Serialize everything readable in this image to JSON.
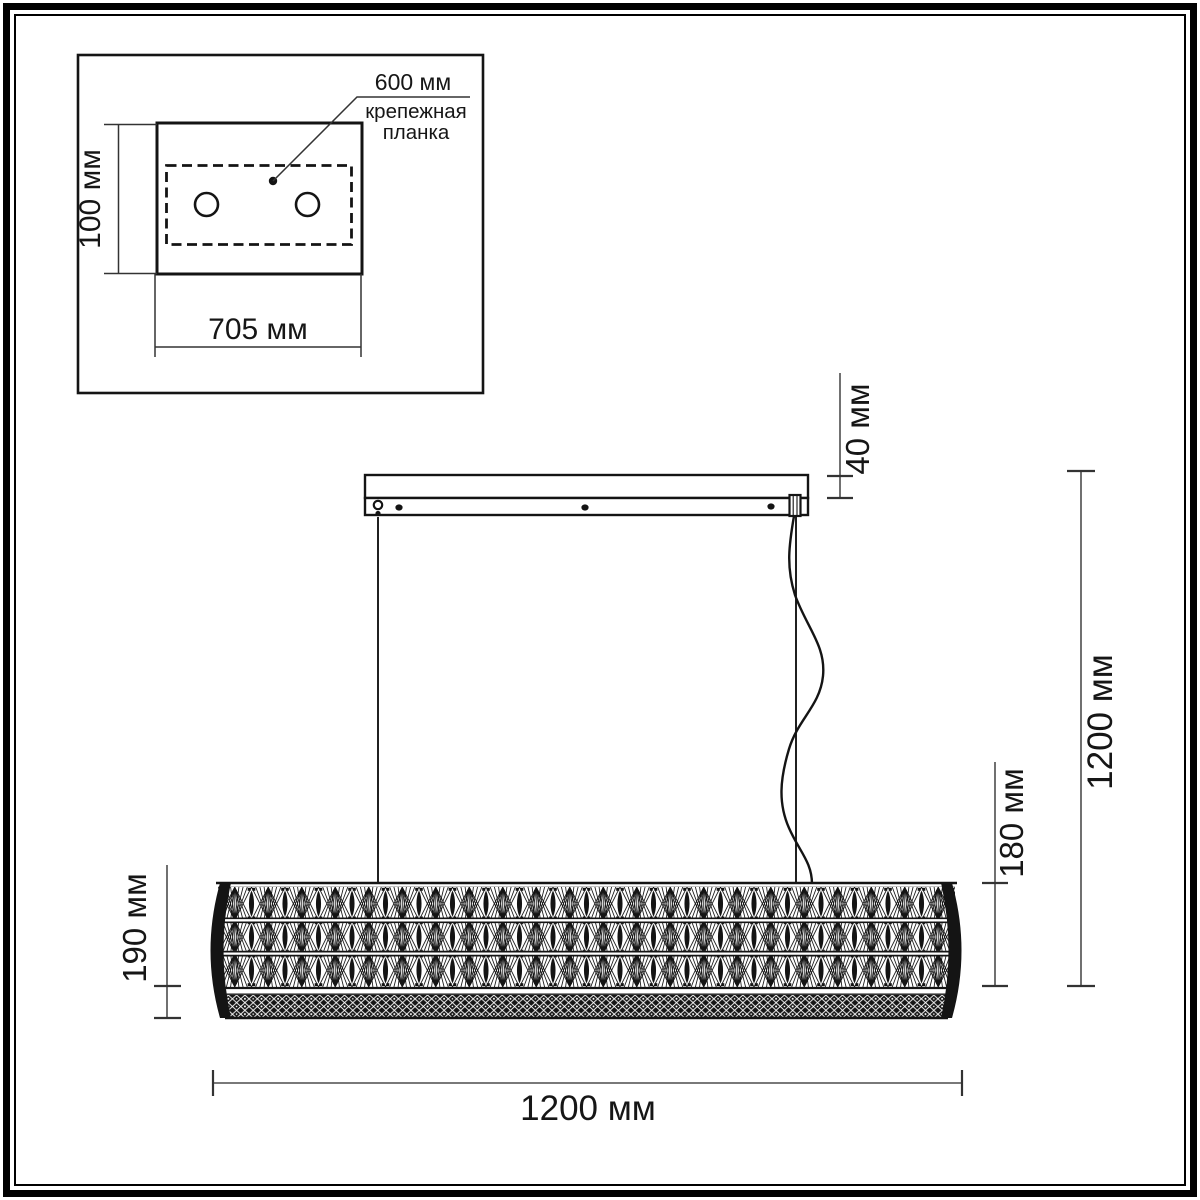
{
  "inset": {
    "plate_height_label": "100 мм",
    "plate_width_label": "705 мм",
    "holes_distance_label": "600 мм",
    "plate_name_line1": "крепежная",
    "plate_name_line2": "планка"
  },
  "dimensions": {
    "canopy_height": "40 мм",
    "suspension_height": "1200 мм",
    "shade_height": "180 мм",
    "fixture_height": "190 мм",
    "fixture_width": "1200 мм"
  },
  "colors": {
    "line": "#141414",
    "dimension_line": "#4d4d4d",
    "background": "#ffffff"
  }
}
